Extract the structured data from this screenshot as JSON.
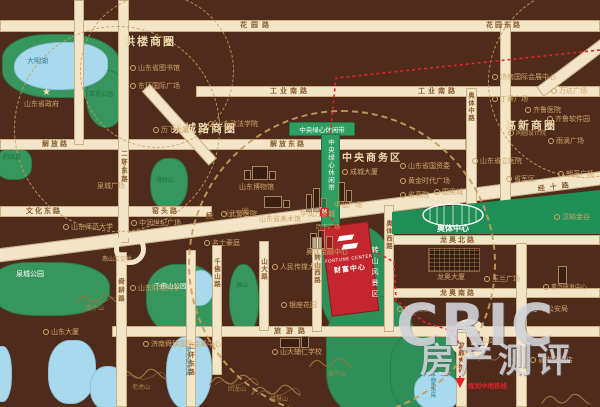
{
  "roads": {
    "huayuan": "花园路",
    "huayuan_e": "花园东路",
    "gongyenan": "工业南路",
    "jiefang": "解放路",
    "jiefang_e": "解放东路",
    "wenhua_e": "文化东路",
    "yaotou": "窑头路",
    "jingshi": "经十路",
    "lvyou": "旅游路",
    "longao_n": "龙奥北路",
    "longao_s": "龙奥南路",
    "erhuan_e": "二环东路",
    "shungeng": "舜耕路",
    "qianfoshan": "千佛山路",
    "shanda": "山大路",
    "zhuanshan_w": "转山西路",
    "aoti_w": "奥体西路",
    "aoti_m": "奥体中路",
    "longding": "龙鼎大道"
  },
  "districts": {
    "honglou": "洪楼商圈",
    "quanchenglu": "泉城路商圈",
    "gaoxin": "高新商圈",
    "cbd": "中央商务区",
    "greenbelt": "中央绿心休闲带",
    "fengjingqu": "转山风景区",
    "aoti_center": "奥体中心"
  },
  "junctions": {
    "yanshan": "燕山立交桥",
    "longding": "龙鼎立交桥"
  },
  "parks": {
    "daminghu": "大明湖",
    "baihua": "百花公园",
    "baotuquan": "趵突泉",
    "maolingshan": "茂岭山",
    "quancheng_park": "泉城公园",
    "qianfoshan_park": "千佛山公园",
    "hongshan": "洪山"
  },
  "lakes": {
    "jiangshuiquan": "浆水泉水库",
    "mengjia": "孟家水库"
  },
  "mountains": {
    "yanzishan": "燕子山",
    "laohushan": "老虎山",
    "huilongshan": "回龙山",
    "muniushan": "母牛山",
    "fohuishan": "佛慧山"
  },
  "pois": {
    "lib": "山东省图书馆",
    "donghuan": "东环国际广场",
    "lixiadasha": "历下大厦",
    "zhengfa": "山东政法学院",
    "shengzhengfu": "山东省政府",
    "quanchengsq": "泉城广场",
    "zhongrun": "中润世纪广场",
    "shanshi": "山东师范大学",
    "wujing": "武警医院",
    "bowuguan": "山东博物馆",
    "meishuguan": "山东省美术馆",
    "wanxiangcheng": "华润万象城",
    "zhonghong": "中弘广场",
    "chengcheng": "成城大厦",
    "mingshi": "名士豪庭",
    "aotijinrong": "奥体金融中心",
    "renminchuanmei": "人民传媒大厦",
    "guoziwei": "山东省国资委",
    "huangjin": "黄金时代广场",
    "guoaocheng": "国奥城",
    "shenggaoyuan": "省高院",
    "shengliyiyuan": "山东省立医院",
    "shengjunqu": "省军区",
    "tongyuan": "同圆设计院",
    "yudi": "雨滴广场",
    "langmao": "朗茂广场",
    "huizhan": "济南国际会展中心",
    "wanda": "万达广场",
    "dinghao": "丁豪广场",
    "qiluyiyuan": "齐鲁医院",
    "qiluruanjian": "齐鲁软件园",
    "hanyu": "汉峪金谷",
    "yulan": "玉兰广场",
    "longaodasha": "龙奥大厦",
    "zhongqi": "重汽研发中心",
    "jianchayuan": "市检察院",
    "gonganju": "市公安局",
    "xilaideng": "喜来登酒店",
    "caijing": "山东财经大学",
    "shungenghuizhan": "济南舜耕国际会展中心",
    "shandongdasha": "山东大厦",
    "yinzuo": "银座花园",
    "furen": "山大辅仁学校",
    "lixiaguangchang": "历下广场"
  },
  "property": {
    "en": "FORTUNE CENTER",
    "cn": "财富中心"
  },
  "metro": {
    "label": "规划中地铁线",
    "station": "M"
  },
  "icons": {
    "star": "★"
  },
  "watermark": {
    "brand": "CRIC",
    "sub": "房产测评"
  },
  "colors": {
    "background": "#4e2b1a",
    "road": "#f2e5c8",
    "park_green": "#37965e",
    "scenic_green": "#2e8f58",
    "lake_blue": "#a9d9ec",
    "accent_red": "#c4262d",
    "gold_text": "#cfa56a",
    "cream_text": "#ecd9ad"
  }
}
